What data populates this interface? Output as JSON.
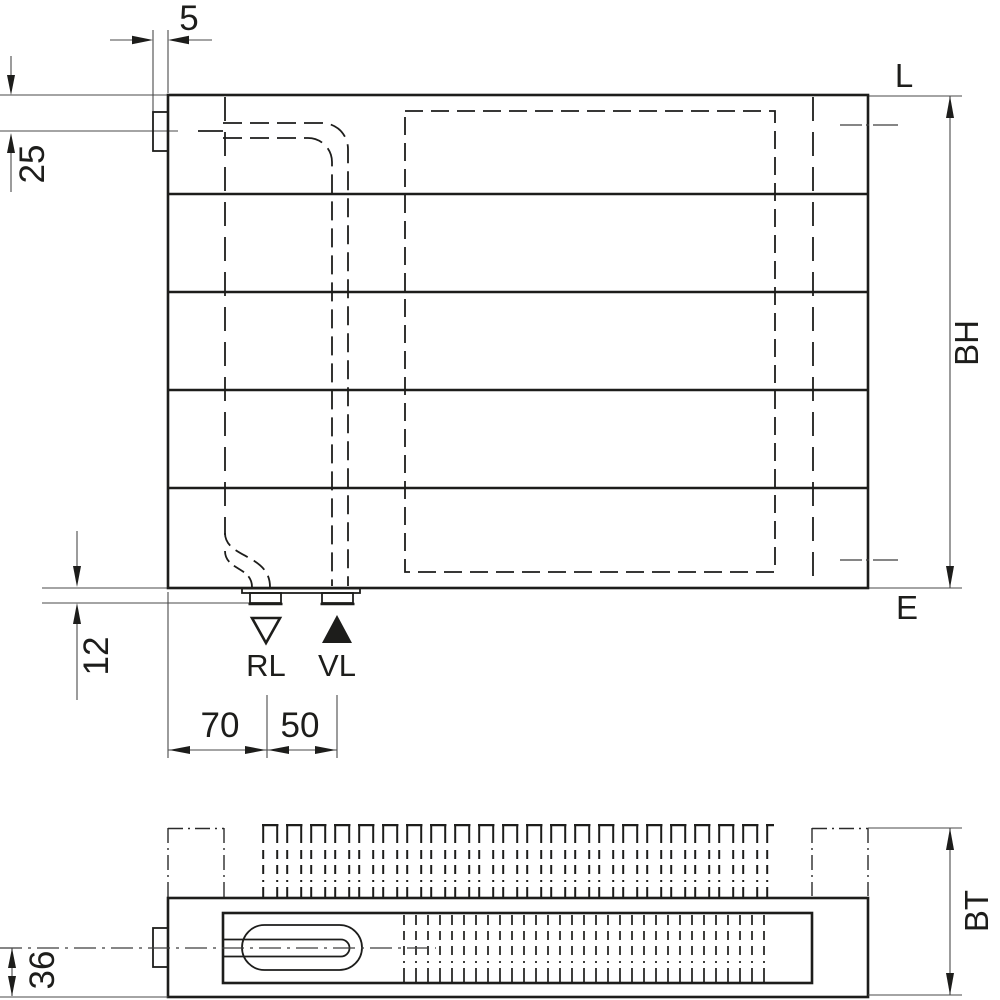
{
  "front_view": {
    "dim_bracket_depth": "5",
    "dim_supply_axis_from_top": "25",
    "dim_connection_protrusion": "12",
    "dim_left_edge_to_rl": "70",
    "dim_rl_to_vl": "50",
    "dim_height": "BH",
    "label_air_vent": "L",
    "label_drain": "E",
    "label_return": "RL",
    "label_supply": "VL"
  },
  "top_view": {
    "dim_depth": "BT",
    "dim_pipe_axis_from_front": "36"
  },
  "colors": {
    "line": "#1d1d1b",
    "dim_line": "#4a4a4a",
    "background": "#ffffff"
  }
}
